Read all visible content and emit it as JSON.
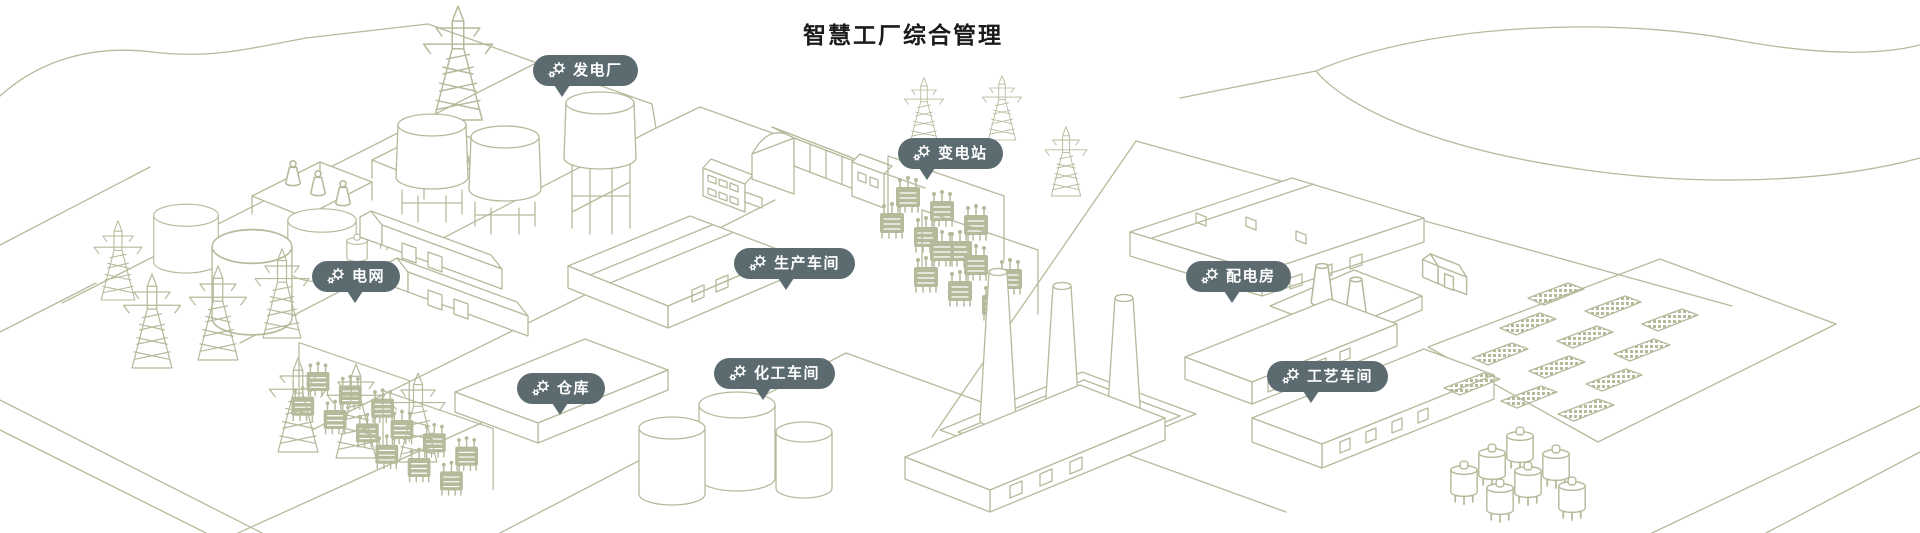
{
  "page": {
    "title": "智慧工厂综合管理",
    "title_color": "#1b1b1b",
    "background_color": "#ffffff"
  },
  "scene": {
    "line_color": "#b5ba9b",
    "marker_background": "#5c6b70",
    "marker_text_color": "#ffffff",
    "marker_icon": "gears-icon",
    "description": "isometric line-art map of a smart factory campus"
  },
  "labels": [
    {
      "id": "power-plant",
      "text": "发电厂"
    },
    {
      "id": "substation",
      "text": "变电站"
    },
    {
      "id": "power-grid",
      "text": "电网"
    },
    {
      "id": "production-workshop",
      "text": "生产车间"
    },
    {
      "id": "distribution-room",
      "text": "配电房"
    },
    {
      "id": "warehouse",
      "text": "仓库"
    },
    {
      "id": "chemical-workshop",
      "text": "化工车间"
    },
    {
      "id": "process-workshop",
      "text": "工艺车间"
    }
  ]
}
